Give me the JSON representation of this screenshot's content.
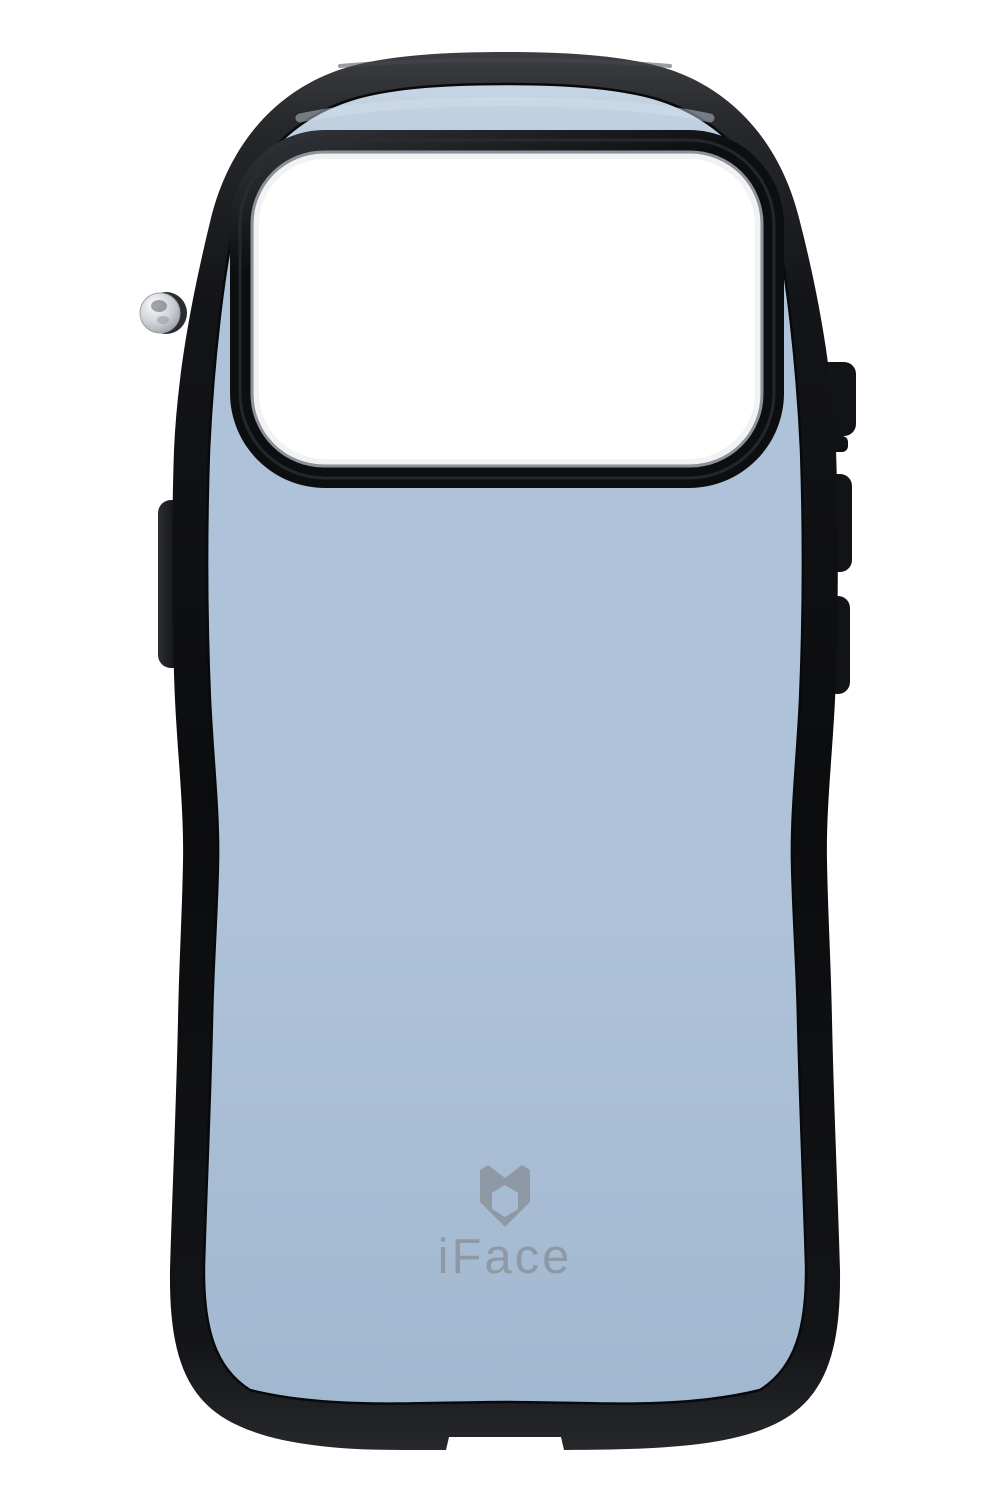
{
  "product": {
    "brand": "iFace",
    "logo_text": "iFace",
    "view": "back of smartphone case",
    "case_color_name": "light blue"
  },
  "colors": {
    "background": "#ffffff",
    "bumper_top_highlight": "#3c3e42",
    "bumper_highlight": "#26282b",
    "bumper_mid": "#131417",
    "bumper_dark": "#0b0c0e",
    "body_blue_light": "#c7d5e4",
    "body_blue": "#aec3d9",
    "body_blue_dark": "#a2b8d0",
    "seam_dark": "#08090b",
    "camera_rim_highlight": "#34373c",
    "camera_rim_dark": "#0d0e10",
    "camera_ring_gray": "#8b929b",
    "camera_window_white": "#ffffff",
    "logo_gray": "#8e99a5",
    "button_dark": "#121316",
    "button_highlight": "#2c2e32",
    "knob_silver_light": "#fafbfc",
    "knob_silver": "#c9cdd3",
    "knob_silver_dark": "#878d95"
  }
}
